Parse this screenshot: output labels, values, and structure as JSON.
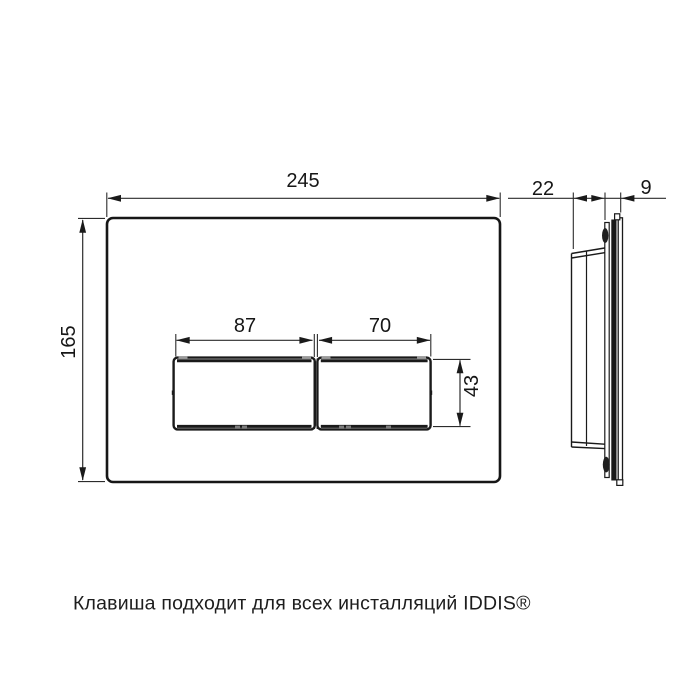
{
  "colors": {
    "background": "#ffffff",
    "line": "#1a1a1a"
  },
  "views": {
    "front": {
      "dimensions": {
        "width_mm": "245",
        "height_mm": "165",
        "left_button_width_mm": "87",
        "right_button_width_mm": "70",
        "button_height_mm": "43"
      }
    },
    "side": {
      "dimensions": {
        "depth_mm": "22",
        "front_plate_thickness_mm": "9"
      }
    }
  },
  "caption": "Клавиша подходит для всех инсталляций IDDIS®"
}
